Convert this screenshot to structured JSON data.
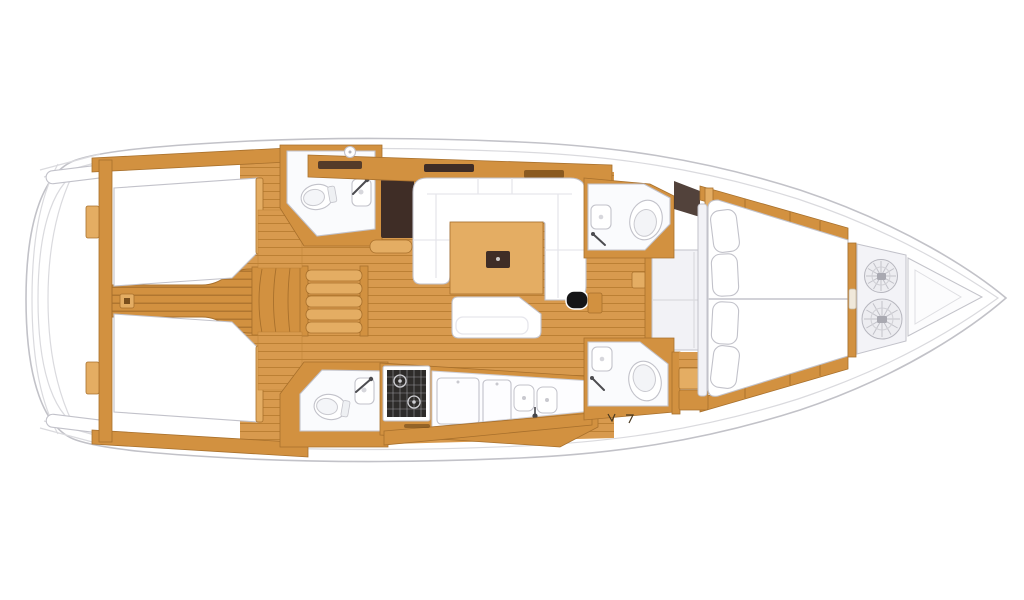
{
  "diagram": {
    "type": "floor-plan",
    "subject": "sailing-yacht-interior-top-view",
    "orientation": "bow-right-stern-left",
    "areas": [
      {
        "id": "transom-swim-platform",
        "label": "rounded transom / swim platform"
      },
      {
        "id": "aft-cabin-port",
        "label": "aft double berth cabin (top)"
      },
      {
        "id": "aft-cabin-starboard",
        "label": "aft double berth cabin (bottom)"
      },
      {
        "id": "aft-corridor",
        "label": "teak walkway between aft cabins"
      },
      {
        "id": "companionway-steps",
        "label": "companionway stairs"
      },
      {
        "id": "aft-head-port",
        "label": "aft bathroom with toilet and sink (top)"
      },
      {
        "id": "aft-head-starboard",
        "label": "aft bathroom with toilet and sink (bottom)"
      },
      {
        "id": "nav-station",
        "label": "chart table / navigation desk"
      },
      {
        "id": "salon",
        "label": "U-shaped settee with wooden table and bench"
      },
      {
        "id": "galley",
        "label": "galley with stove, worktops and double sink"
      },
      {
        "id": "forward-head-port",
        "label": "forward bathroom (top)"
      },
      {
        "id": "forward-head-starboard",
        "label": "forward shower room with steps (bottom)"
      },
      {
        "id": "forward-cabin",
        "label": "V-berth owner cabin with four pillows"
      },
      {
        "id": "bow-locker",
        "label": "anchor locker with two rope coils"
      }
    ],
    "fixture_icons": [
      "toilet-icon",
      "sink-icon",
      "shower-mixer-icon",
      "stove-icon",
      "double-sink-icon",
      "deck-hatch-icon",
      "table-hatch-icon",
      "rope-coil-icon",
      "pillow-icon"
    ],
    "counts": {
      "berths": 3,
      "toilets": 4,
      "rope_coils": 2,
      "pillows": 4
    }
  },
  "colors": {
    "hull_outline": "#c2c2c8",
    "deck_line": "#dadade",
    "wood_main": "#d29140",
    "wood_light": "#e4ad63",
    "wood_floor": "#d89a4e",
    "wood_stripe": "#bc8034",
    "wood_edge": "#a8702c",
    "dark_brown": "#3f2d26",
    "stove_black": "#2e2c2a",
    "fixture_outline": "#c2c2ca",
    "room_white": "#fafbfd",
    "cushion_seam": "#e6e6ec",
    "platform_gray": "#f2f2f6",
    "locker_gray": "#f3f3f7",
    "rope_gray": "#ededf1",
    "accent_black": "#151517"
  }
}
